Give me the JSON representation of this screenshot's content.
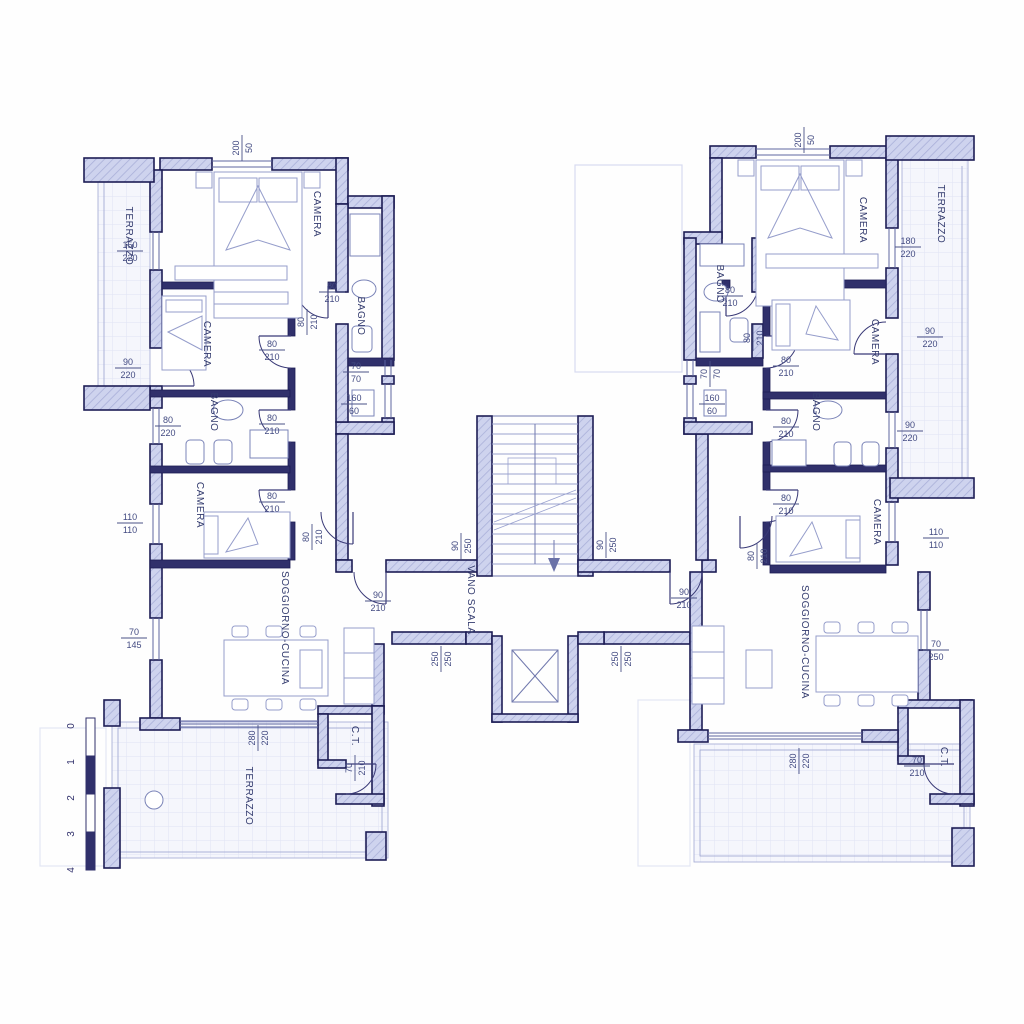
{
  "colors": {
    "wall_outline": "#1d1d55",
    "wall_fill": "#ced3ee",
    "partition": "#30306b",
    "furniture_line": "#959dcb",
    "dimension_text": "#434b82",
    "room_text": "#333b6e",
    "paper": "#fefefe"
  },
  "rooms": {
    "left": {
      "terrazzo": "TERRAZZO",
      "camera1": "CAMERA",
      "bagno1": "BAGNO",
      "camera2": "CAMERA",
      "bagno2": "BAGNO",
      "camera3": "CAMERA",
      "soggiorno": "SOGGIORNO-CUCINA",
      "ct": "C.T.",
      "terrazzo2": "TERRAZZO"
    },
    "core": {
      "vano_scala": "VANO SCALA"
    },
    "right": {
      "camera1": "CAMERA",
      "terrazzo": "TERRAZZO",
      "bagno1": "BAGNO",
      "camera2": "CAMERA",
      "bagno2": "BAGNO",
      "camera3": "CAMERA",
      "soggiorno": "SOGGIORNO-CUCINA",
      "ct": "C.T."
    }
  },
  "dims": {
    "l1": {
      "t": "200",
      "b": "50"
    },
    "l2": {
      "t": "150",
      "b": "220"
    },
    "l3": {
      "t": "80",
      "b": "210"
    },
    "l4": {
      "t": "80",
      "b": "210"
    },
    "l5": {
      "t": "80",
      "b": "210"
    },
    "l6": {
      "t": "90",
      "b": "220"
    },
    "l7": {
      "t": "70",
      "b": "70"
    },
    "l8": {
      "t": "160",
      "b": "60"
    },
    "l9": {
      "t": "80",
      "b": "220"
    },
    "l10": {
      "t": "80",
      "b": "210"
    },
    "l11": {
      "t": "80",
      "b": "210"
    },
    "l12": {
      "t": "110",
      "b": "110"
    },
    "l13": {
      "t": "80",
      "b": "210"
    },
    "l14": {
      "t": "70",
      "b": "145"
    },
    "l15": {
      "t": "90",
      "b": "210"
    },
    "l16": {
      "t": "280",
      "b": "220"
    },
    "l17": {
      "t": "70",
      "b": "210"
    },
    "c1": {
      "t": "90",
      "b": "250"
    },
    "c2": {
      "t": "90",
      "b": "250"
    },
    "c3": {
      "t": "250",
      "b": "250"
    },
    "c4": {
      "t": "250",
      "b": "250"
    },
    "r1": {
      "t": "200",
      "b": "50"
    },
    "r2": {
      "t": "180",
      "b": "220"
    },
    "r3": {
      "t": "80",
      "b": "210"
    },
    "r4": {
      "t": "80",
      "b": "210"
    },
    "r5": {
      "t": "90",
      "b": "220"
    },
    "r6": {
      "t": "80",
      "b": "210"
    },
    "r7": {
      "t": "70",
      "b": "70"
    },
    "r8": {
      "t": "160",
      "b": "60"
    },
    "r9": {
      "t": "80",
      "b": "210"
    },
    "r10": {
      "t": "90",
      "b": "220"
    },
    "r11": {
      "t": "80",
      "b": "210"
    },
    "r12": {
      "t": "110",
      "b": "110"
    },
    "r13": {
      "t": "80",
      "b": "210"
    },
    "r14": {
      "t": "90",
      "b": "210"
    },
    "r15": {
      "t": "70",
      "b": "250"
    },
    "r16": {
      "t": "280",
      "b": "220"
    },
    "r17": {
      "t": "70",
      "b": "210"
    }
  },
  "scale_bar": {
    "labels": [
      "0",
      "1",
      "2",
      "3",
      "4"
    ]
  }
}
